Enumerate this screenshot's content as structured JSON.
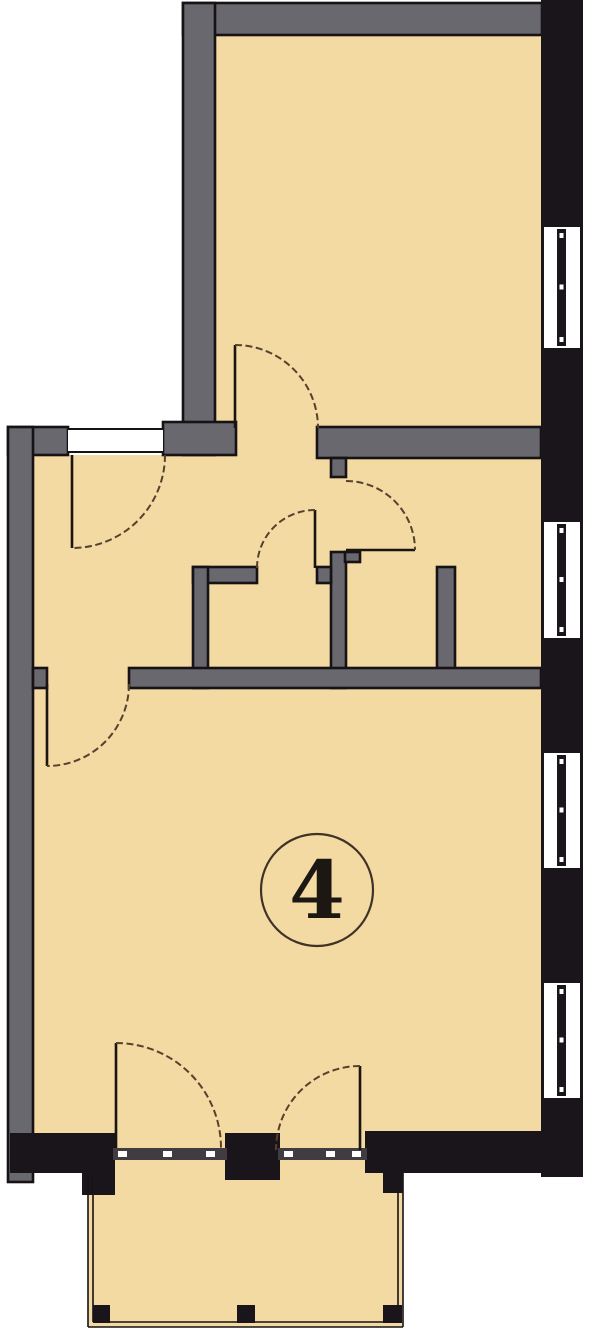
{
  "document": {
    "type": "architectural-floor-plan",
    "room_label": {
      "text": "4",
      "cx": 317,
      "cy": 890,
      "r": 56,
      "font_size": 80
    }
  },
  "colors": {
    "floor": "#f3d9a2",
    "wall_gray": "#68686e",
    "wall_black": "#1a151a",
    "outline": "#16121518",
    "outline_solid": "#161215",
    "leaf": "#1a1510",
    "arc": "#54422d",
    "threshold": "#403c42",
    "white": "#ffffff",
    "label_stroke": "#3f3227",
    "label_text": "#1c1713"
  },
  "plan": {
    "width": 606,
    "height": 1342,
    "floors": [
      {
        "name": "upper-room-floor",
        "r": [
          215,
          35,
          330,
          423
        ]
      },
      {
        "name": "main-rooms-floor",
        "r": [
          33,
          455,
          508,
          718
        ]
      },
      {
        "name": "balcony-floor",
        "r": [
          88,
          1173,
          315,
          154
        ]
      }
    ],
    "gray_walls": [
      [
        183,
        3,
        359,
        32
      ],
      [
        183,
        3,
        32,
        452
      ],
      [
        163,
        422,
        73,
        33
      ],
      [
        317,
        427,
        224,
        31
      ],
      [
        8,
        427,
        60,
        28
      ],
      [
        8,
        427,
        25,
        755
      ],
      [
        193,
        567,
        64,
        16
      ],
      [
        193,
        567,
        15,
        121
      ],
      [
        331,
        458,
        15,
        19
      ],
      [
        331,
        552,
        15,
        136
      ],
      [
        345,
        552,
        15,
        10
      ],
      [
        317,
        567,
        14,
        16
      ],
      [
        437,
        567,
        18,
        116
      ],
      [
        33,
        668,
        14,
        20
      ],
      [
        129,
        668,
        412,
        20
      ]
    ],
    "black_walls": [
      [
        541,
        0,
        42,
        1177
      ],
      [
        10,
        1133,
        105,
        40
      ],
      [
        82,
        1173,
        33,
        22
      ],
      [
        225,
        1133,
        55,
        47
      ],
      [
        365,
        1131,
        176,
        42
      ]
    ],
    "thresholds": {
      "bands": [
        [
          113,
          1148,
          114,
          12
        ],
        [
          278,
          1148,
          89,
          12
        ]
      ],
      "dashes": [
        [
          118,
          1151
        ],
        [
          163,
          1151
        ],
        [
          206,
          1151
        ],
        [
          284,
          1151
        ],
        [
          326,
          1151
        ],
        [
          352,
          1151
        ]
      ]
    },
    "window_frame": {
      "x": 544,
      "w": 36,
      "bar_x": 557,
      "bar_w": 9
    },
    "windows": [
      {
        "name": "window-1",
        "y": 227,
        "h": 121
      },
      {
        "name": "window-2",
        "y": 522,
        "h": 116
      },
      {
        "name": "window-3",
        "y": 753,
        "h": 115
      },
      {
        "name": "window-4",
        "y": 983,
        "h": 115
      }
    ],
    "entrance_opening": {
      "rect": [
        68,
        429,
        95,
        23
      ],
      "top_line": [
        68,
        429,
        163,
        429
      ],
      "bottom_line": [
        68,
        452,
        163,
        452
      ]
    },
    "balcony": {
      "rail_lines": [
        [
          88,
          1173,
          88,
          1327
        ],
        [
          403,
          1173,
          403,
          1327
        ],
        [
          88,
          1327,
          403,
          1327
        ],
        [
          93,
          1177,
          93,
          1322
        ],
        [
          398,
          1177,
          398,
          1322
        ],
        [
          93,
          1322,
          398,
          1322
        ]
      ],
      "posts": [
        [
          93,
          1177,
          17,
          18
        ],
        [
          383,
          1172,
          20,
          21
        ],
        [
          93,
          1305,
          17,
          18
        ],
        [
          237,
          1305,
          18,
          18
        ],
        [
          383,
          1305,
          19,
          18
        ]
      ]
    },
    "door_leaves": [
      {
        "name": "entrance-door-leaf",
        "l": [
          72,
          455,
          72,
          548
        ]
      },
      {
        "name": "upper-room-door-leaf",
        "l": [
          235,
          345,
          235,
          428
        ]
      },
      {
        "name": "storage-door-leaf",
        "l": [
          315,
          510,
          315,
          568
        ]
      },
      {
        "name": "bath-door-leaf",
        "l": [
          346,
          550,
          415,
          550
        ]
      },
      {
        "name": "living-room-door-leaf",
        "l": [
          47,
          684,
          47,
          766
        ]
      },
      {
        "name": "balcony-left-door-leaf",
        "l": [
          116,
          1043,
          116,
          1148
        ]
      },
      {
        "name": "balcony-right-door-leaf",
        "l": [
          360,
          1066,
          360,
          1150
        ]
      }
    ],
    "door_arcs": [
      {
        "name": "entrance-door-arc",
        "d": "M 165,455 A 93,93 0 0 1 72,548"
      },
      {
        "name": "upper-room-door-arc",
        "d": "M 235,345 A 83,83 0 0 1 318,428"
      },
      {
        "name": "storage-door-arc",
        "d": "M 257,568 A 58,58 0 0 1 315,510"
      },
      {
        "name": "bath-door-arc",
        "d": "M 346,481 A 69,69 0 0 1 415,550"
      },
      {
        "name": "living-room-door-arc",
        "d": "M 129,684 A 82,82 0 0 1 47,766"
      },
      {
        "name": "balcony-left-door-arc",
        "d": "M 116,1043 A 105,105 0 0 1 221,1148"
      },
      {
        "name": "balcony-right-door-arc",
        "d": "M 360,1066 A 84,84 0 0 0 276,1150"
      }
    ]
  }
}
